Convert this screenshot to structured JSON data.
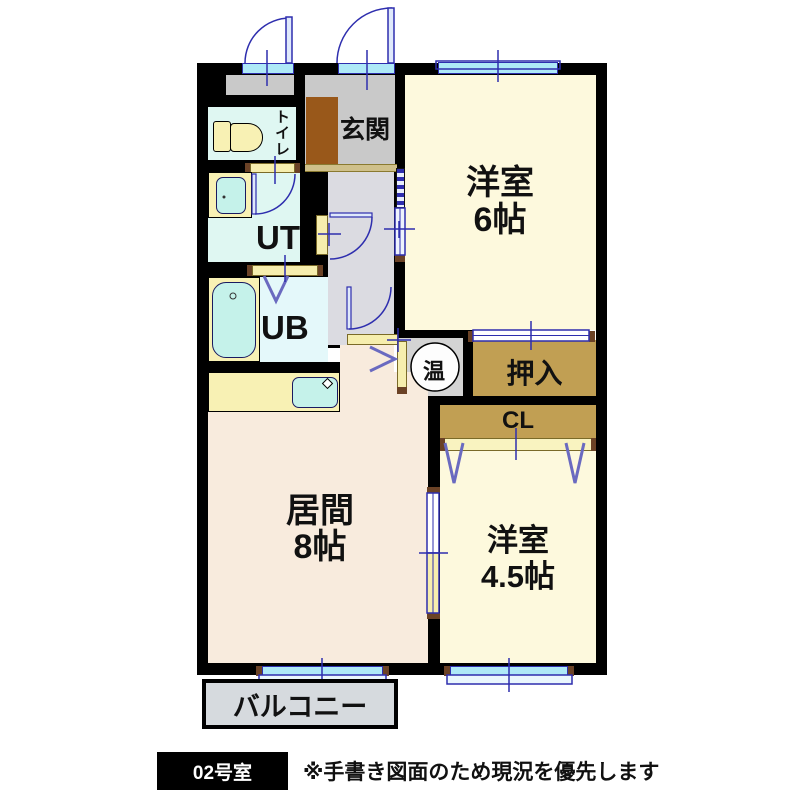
{
  "plan": {
    "type": "apartment-floor-plan",
    "rooms": {
      "toilet": {
        "label": "トイレ"
      },
      "entrance": {
        "label": "玄関"
      },
      "western6": {
        "label": "洋室",
        "size": "6帖"
      },
      "utility": {
        "label": "UT"
      },
      "bath": {
        "label": "UB"
      },
      "water_heater": {
        "label": "温"
      },
      "oshiire": {
        "label": "押入"
      },
      "closet": {
        "label": "CL"
      },
      "living": {
        "label": "居間",
        "size": "8帖"
      },
      "western45": {
        "label": "洋室",
        "size": "4.5帖"
      },
      "balcony": {
        "label": "バルコニー"
      }
    },
    "footer": {
      "room_number": "02号室",
      "note": "※手書き図面のため現況を優先します"
    },
    "colors": {
      "wall": "#000000",
      "tatami_room": "#fdf9dd",
      "living_room": "#f8ebdd",
      "wet_room": "#dff7f2",
      "closet_tan": "#c19f53",
      "entry_gray": "#c9c9c9",
      "hall_gray": "#dbdbe1",
      "window_cyan": "#aee9f7",
      "line_blue": "#2e2eae",
      "mat_brown": "#99581a",
      "fixture_yellow": "#f8f1b4",
      "fixture_cyan": "#c5f2ea",
      "balcony_gray": "#d6dade"
    }
  }
}
